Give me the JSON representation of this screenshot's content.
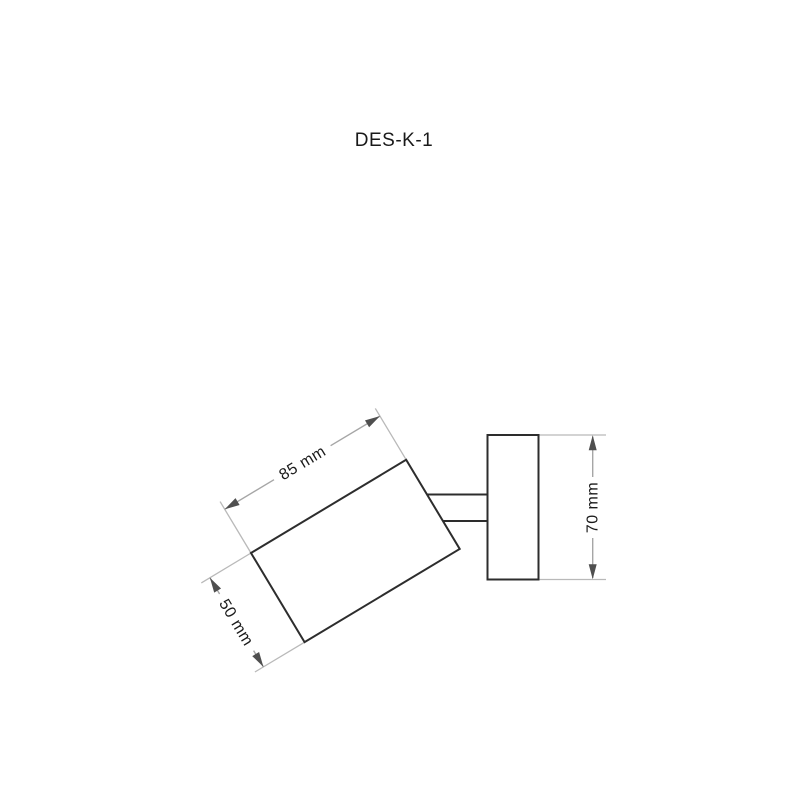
{
  "header": {
    "title": "DES-K-1"
  },
  "diagram": {
    "type": "technical-dimension-drawing",
    "parts": {
      "lamp_head": "tilted cylinder body",
      "arm": "connector arm",
      "wall_bracket": "mounting plate"
    },
    "labels": {
      "head_length": "85 mm",
      "head_diameter": "50 mm",
      "bracket_height": "70 mm"
    },
    "colors": {
      "outline": "#2d2d2d",
      "dimension_line": "#a6a6a6",
      "extension_line": "#b9b9b9",
      "arrowhead": "#4f4f4f",
      "label_text": "#1a1a1a",
      "background": "#ffffff"
    }
  }
}
